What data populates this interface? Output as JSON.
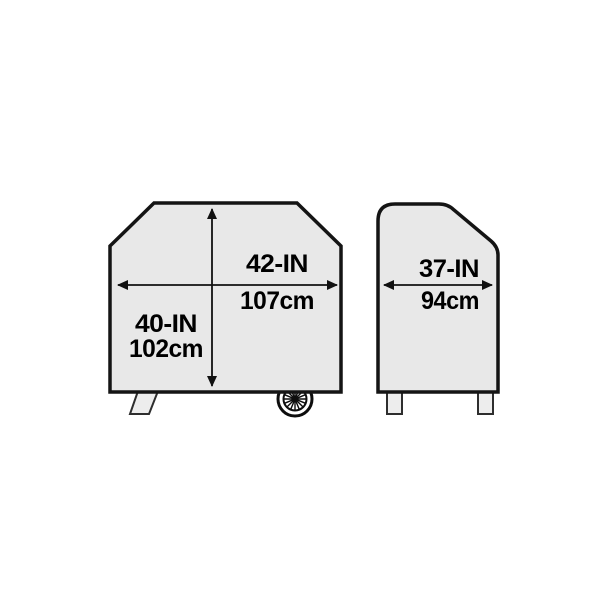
{
  "diagram": {
    "type": "product-dimension-diagram",
    "subject": "grill-cover",
    "views": {
      "front": {
        "width": {
          "inches": "42-IN",
          "centimeters": "107cm"
        },
        "height": {
          "inches": "40-IN",
          "centimeters": "102cm"
        }
      },
      "side": {
        "depth": {
          "inches": "37-IN",
          "centimeters": "94cm"
        }
      }
    },
    "colors": {
      "cover_fill": "#e8e8e8",
      "outline": "#141414",
      "leg_fill": "#ededed",
      "background": "#ffffff",
      "text": "#000000"
    }
  }
}
